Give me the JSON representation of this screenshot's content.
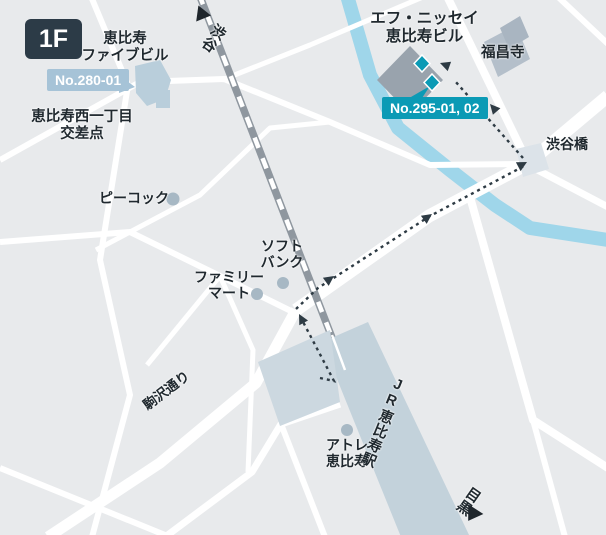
{
  "colors": {
    "background": "#e8eaec",
    "road": "#ffffff",
    "railway": "#8f979f",
    "river": "#9fd6ea",
    "route": "#2e3b44",
    "arrow": "#1f262c",
    "station_fill": "#c3d2db",
    "atre_fill": "#ccd8e0",
    "building_light": "#b9cedb",
    "building_dark": "#99a3ad",
    "temple_fill": "#b4bfca",
    "temple_fill_dark": "#a9b5c1",
    "bridge_fill": "#dce3e9",
    "poi_dot": "#a7b8c4",
    "badge_light_bg": "#a6c3d7",
    "badge_teal_bg": "#0b9ab5",
    "floor_badge_bg": "#2c3b47",
    "text": "#20292f"
  },
  "floor_badge": "1F",
  "badges": {
    "no280": "No.280-01",
    "no295": "No.295-01, 02"
  },
  "labels": {
    "ebisu_five": {
      "line1": "恵比寿",
      "line2": "ファイブビル"
    },
    "intersection": {
      "line1": "恵比寿西一丁目",
      "line2": "交差点"
    },
    "peacock": "ピーコック",
    "familymart": {
      "line1": "ファミリー",
      "line2": "マート"
    },
    "softbank": {
      "line1": "ソフト",
      "line2": "バンク"
    },
    "f_nissei": {
      "line1": "エフ・ニッセイ",
      "line2": "恵比寿ビル"
    },
    "fukushoji": "福昌寺",
    "shibuyabashi": "渋谷橋",
    "komazawa_dori": "駒沢通り",
    "atre": {
      "line1": "アトレ",
      "line2": "恵比寿"
    },
    "jr_station": "JR恵比寿駅",
    "direction_north": "渋谷",
    "direction_south": "目黒"
  }
}
